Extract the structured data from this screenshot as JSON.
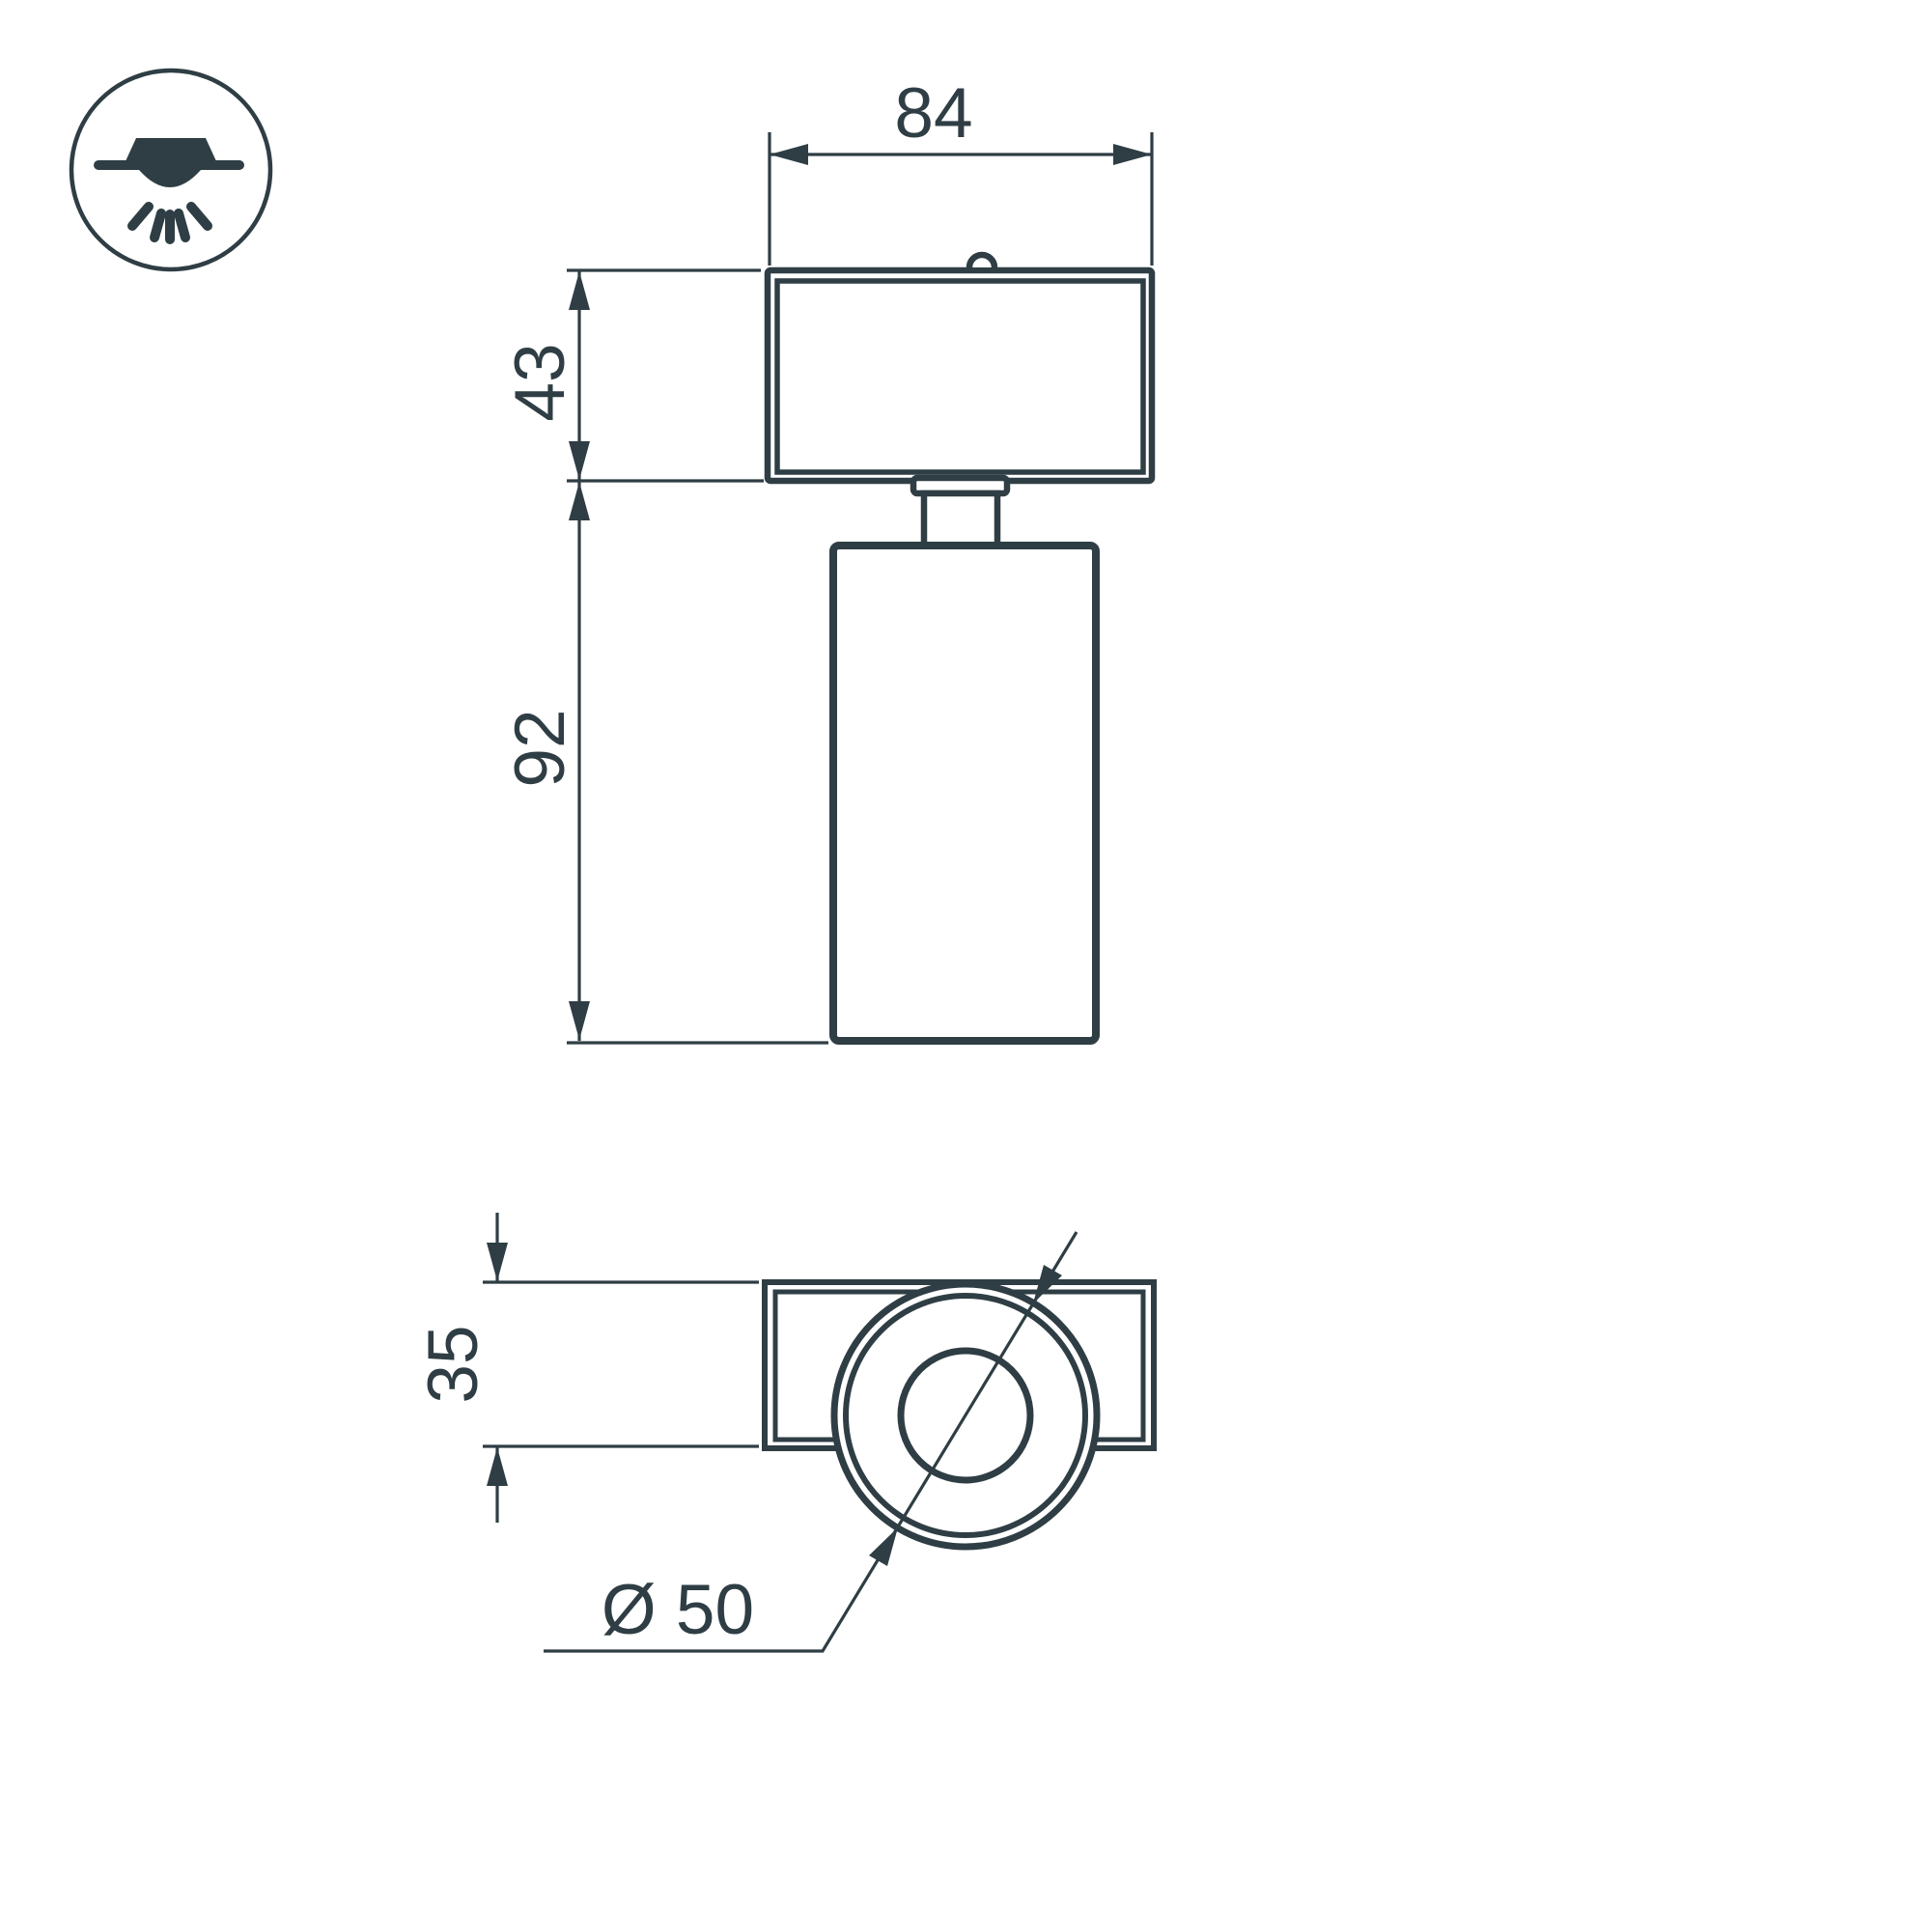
{
  "page": {
    "type": "product-dimension-drawing",
    "background": "#ffffff"
  },
  "colors": {
    "ink": "#2f3e44",
    "bg": "#ffffff"
  },
  "icon": {
    "meaning": "surface-mounted-ceiling-light"
  },
  "views": {
    "front": {
      "dimensions": {
        "width": {
          "label": "84",
          "value": 84
        },
        "head_height": {
          "label": "43",
          "value": 43
        },
        "body_height": {
          "label": "92",
          "value": 92
        }
      }
    },
    "bottom": {
      "dimensions": {
        "depth": {
          "label": "35",
          "value": 35
        },
        "diameter": {
          "label": "Ø 50",
          "value": 50
        }
      }
    }
  }
}
